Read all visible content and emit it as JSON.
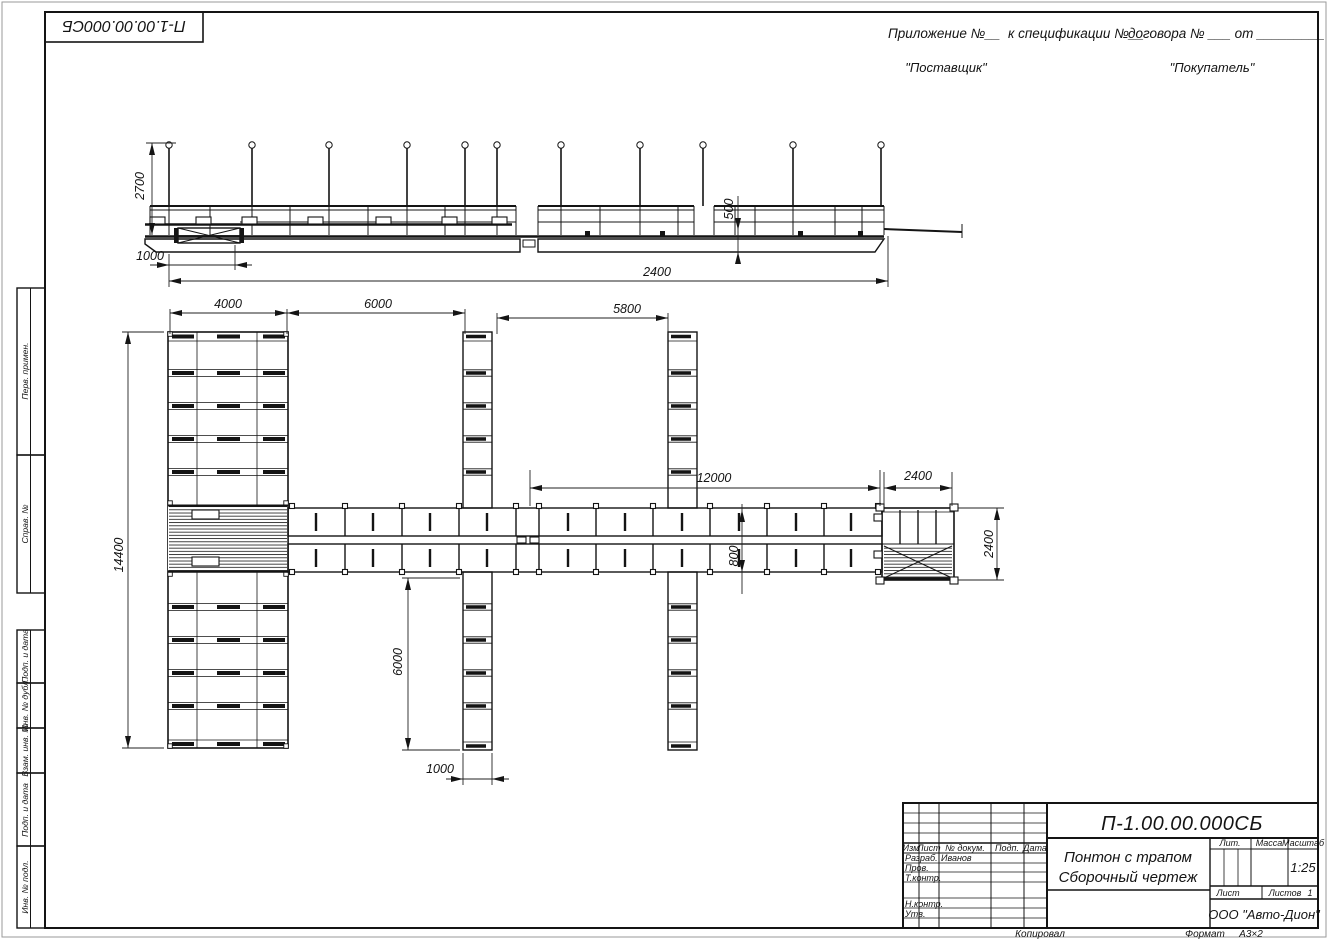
{
  "sheet": {
    "stamp_top_left": "П-1.00.00.000СБ",
    "appendix_1": "Приложение №__",
    "appendix_2": "к спецификации №__",
    "appendix_3": "договора № ___ от _________",
    "supplier": "\"Поставщик\"",
    "buyer": "\"Покупатель\"",
    "footer": {
      "copied": "Копировал",
      "format_label": "Формат",
      "format_value": "А3×2"
    }
  },
  "margin_columns": {
    "perv": "Перв. примен.",
    "sprav": "Справ. №",
    "podp1": "Подп. и дата",
    "inv_dubl": "Инв. № дубл.",
    "vzam": "Взам. инв. №",
    "podp2": "Подп. и дата",
    "inv_podl": "Инв. № подл."
  },
  "dimensions": {
    "side_height": "2700",
    "side_offset": "1000",
    "side_total": "2400",
    "side_freeboard": "500",
    "plan_4000": "4000",
    "plan_6000": "6000",
    "plan_5800": "5800",
    "plan_12000": "12000",
    "plan_2400_top": "2400",
    "plan_800": "800",
    "plan_2400_right": "2400",
    "plan_14400": "14400",
    "plan_6000_v": "6000",
    "plan_1000": "1000"
  },
  "title_block": {
    "doc_number": "П-1.00.00.000СБ",
    "title_line1": "Понтон с трапом",
    "title_line2": "Сборочный чертеж",
    "org": "ООО \"Авто-Дион\"",
    "cols": {
      "izm": "Изм",
      "list": "Лист",
      "doc": "№ докум.",
      "podp": "Подп.",
      "data": "Дата"
    },
    "rows": {
      "razrab": "Разраб.",
      "razrab_name": "Иванов",
      "prov": "Пров.",
      "tkontr": "Т.контр.",
      "nkontr": "Н.контр.",
      "utv": "Утв."
    },
    "lit": "Лит.",
    "massa": "Масса",
    "masshtab": "Масштаб",
    "scale": "1:25",
    "sheet_label": "Лист",
    "sheets_label": "Листов",
    "sheets_value": "1"
  }
}
